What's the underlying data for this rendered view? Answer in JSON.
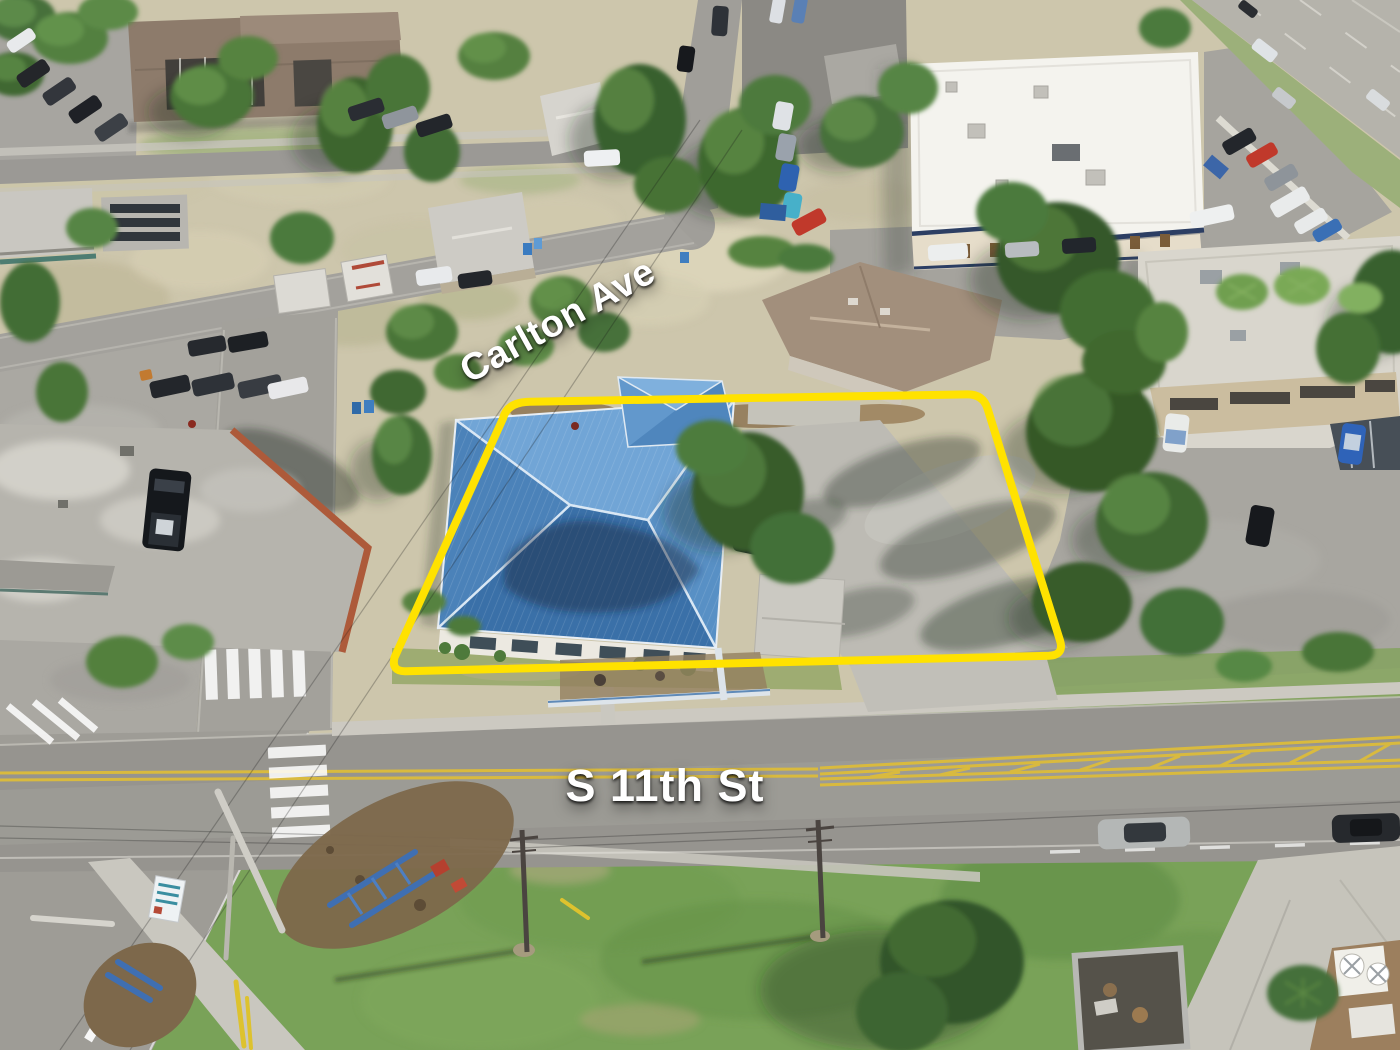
{
  "scene": {
    "type": "aerial-drone-photo",
    "subject": "Aerial view of a corner commercial property with a blue metal hip roof, outlined with a yellow property-boundary overlay, at the corner of Carlton Ave and S 11th St",
    "colors": {
      "boundary_yellow": "#ffe200",
      "label_text": "#ffffff",
      "roof_blue": "#4b82b9",
      "grass": "#79a258",
      "asphalt": "#96948f",
      "scrub": "#cdc6ac",
      "concrete": "#cac8c0"
    }
  },
  "labels": {
    "carlton_ave": "Carlton Ave",
    "s_11th_st": "S 11th St"
  }
}
